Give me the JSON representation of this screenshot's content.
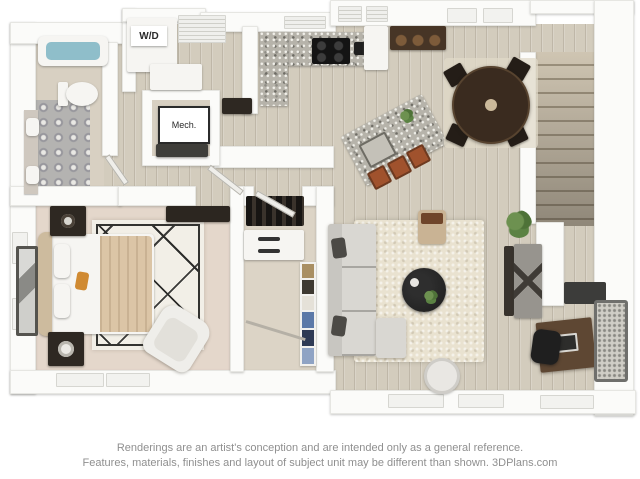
{
  "image": {
    "width": 640,
    "height": 479,
    "kind": "3D apartment floor plan rendering, top-down view"
  },
  "labels": {
    "washer_dryer": "W/D",
    "mechanical": "Mech."
  },
  "disclaimer": {
    "line1": "Renderings are an artist's conception and are intended only as a general reference.",
    "line2": "Features, materials, finishes and layout of subject unit may be different than shown. 3DPlans.com"
  },
  "palette": {
    "background": "#ffffff",
    "walls": "#fbfbf9",
    "wood_floor": "#d3ccbd",
    "bedroom_carpet": "#e4d7cb",
    "closet_carpet": "#dcd4c6",
    "bathroom_ornate_tile": "#b4b3b1",
    "granite_counter": "#b6b3aa",
    "tub_water": "#8fbeca",
    "living_rug": "#e9e2d0",
    "geometric_rug": "#f2efe7",
    "sofa": "#d9d7d2",
    "dining_table": "#3a2b1f",
    "bar_stool": "#a0522d",
    "bed_blanket": "#dbc5a6",
    "accent_pillow": "#d08a32",
    "plant_green": "#567d3f",
    "coffee_table": "#1c1c1c",
    "disclaimer_text": "#8f8f8f"
  },
  "rooms": [
    {
      "name": "bathroom",
      "items": [
        "bathtub with water",
        "toilet",
        "double sinks",
        "ornate tile floor"
      ]
    },
    {
      "name": "laundry-closet",
      "items": [
        "stacked washer dryer labeled W/D",
        "counter",
        "shelf unit"
      ]
    },
    {
      "name": "mechanical-closet",
      "items": [
        "Mech. sign",
        "dark shelf"
      ]
    },
    {
      "name": "kitchen",
      "items": [
        "L-shaped granite counter",
        "cooktop",
        "sink",
        "fridge",
        "bar console",
        "granite island with sink and plant",
        "three bar stools"
      ]
    },
    {
      "name": "dining-area",
      "items": [
        "round dark wood table",
        "four chairs",
        "area rug"
      ]
    },
    {
      "name": "staircase",
      "items": [
        "wood treads descending"
      ]
    },
    {
      "name": "bedroom",
      "items": [
        "bed with tan blanket and orange pillow",
        "two nightstands with lamps",
        "leaning mirror",
        "geometric rug",
        "white armchair",
        "dresser"
      ]
    },
    {
      "name": "walk-in-closet",
      "items": [
        "shoe shelf",
        "drawer unit",
        "folded clothes cubbies",
        "hanging rod"
      ]
    },
    {
      "name": "living-room",
      "items": [
        "sectional sofa with dark pillows",
        "cream shag rug",
        "round black coffee table with plant",
        "ottoman with tray",
        "side table",
        "potted plant",
        "media console with speakers",
        "wall tv"
      ]
    },
    {
      "name": "desk-nook",
      "items": [
        "wood desk with laptop",
        "black office chair",
        "framed pegboard"
      ]
    }
  ]
}
